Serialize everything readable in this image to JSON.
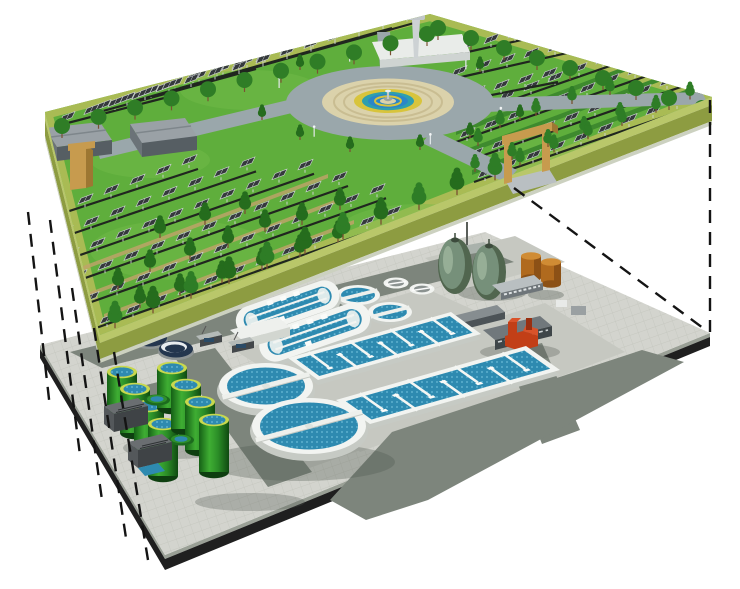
{
  "image_type": "3d-exploded-illustration",
  "subject": "Underground wastewater treatment plant beneath a solar-park landscape, shown as two stacked layers joined by dashed projection lines",
  "palette": {
    "background": "#ffffff",
    "grass": "#5fae3c",
    "grass_light": "#74bd4a",
    "park_border": "#a9bb54",
    "park_bevel": "#b9c76a",
    "park_side": "#8d9c41",
    "park_side_strip": "#ccd1c0",
    "panel_dark": "#35393c",
    "panel_frame": "#ced3d6",
    "tree_dark": "#256c1d",
    "tree_mid": "#2e7d26",
    "tree_back": "#2f7d26",
    "trunk": "#7a5233",
    "hedge": "#3e8a2e",
    "path_tan": "#c2a36a",
    "plaza_road": "#9aa7ab",
    "plaza_paving": "#dbd2ab",
    "plaza_ring": "#c9bd92",
    "fountain_yellow": "#d8c43c",
    "fountain_teal": "#2f9fae",
    "fountain_water": "#2b86c8",
    "building_roof": "#9aa1a6",
    "building_side": "#565e63",
    "building_end": "#6b7378",
    "gate_tan": "#c79b4e",
    "gate_dark": "#9d7732",
    "tower_gray": "#c2c7ca",
    "white_struct": "#eef0ed",
    "plant_tile": "#d3d4ce",
    "tile_line": "#c2c4bc",
    "plant_road": "#7d857c",
    "plant_apron": "#c6c8c1",
    "plant_side_black": "#1f1f1f",
    "plant_side_strip": "#9aa096",
    "shadow": "#4e564e",
    "clarifier_rim": "#f2f4f1",
    "clarifier_wall": "#c6cac4",
    "water_blue": "#2e8ab0",
    "water_dots": "#6cbcd8",
    "egg_green": "#76907a",
    "egg_dark": "#51664f",
    "fuel_orange": "#b06a1e",
    "fuel_top": "#d08c34",
    "pump_red": "#c23f17",
    "pump_red_top": "#d9532a",
    "tank_green_light": "#3fae33",
    "tank_green_dark": "#156016",
    "tank_rim": "#c8d84e",
    "navy_tank": "#24364e",
    "equip_dark": "#43474a",
    "dash_color": "#141414"
  },
  "upper_park": {
    "name": "solar park landscape layer",
    "solar_panel_fields": 4,
    "solar_panels_estimate": 190,
    "trees_estimate": 90,
    "fountain_plaza": {
      "ring_road": 1,
      "paved_rings": 2,
      "fountain_rings": 3
    },
    "service_buildings": 2,
    "entrance_gates": 2,
    "observation_tower": 1
  },
  "lower_plant": {
    "name": "wastewater treatment plant layer",
    "egg_digesters": 2,
    "fuel_tanks": 2,
    "sludge_storage_tanks": 8,
    "low_green_tanks": 2,
    "covered_navy_tanks": 2,
    "oxidation_ditches": 2,
    "ditch_lanes": 2,
    "mini_clarifiers": 2,
    "medium_clarifiers": 2,
    "large_clarifiers": 2,
    "aeration_basins": 2,
    "basin_dividers": 7,
    "service_buildings": 4,
    "red_pump_station": 1,
    "substation_units": 2
  },
  "connectors": {
    "left_dashed_lines": 5,
    "right_dashed_lines": 2,
    "dash_pattern": "13 9"
  }
}
